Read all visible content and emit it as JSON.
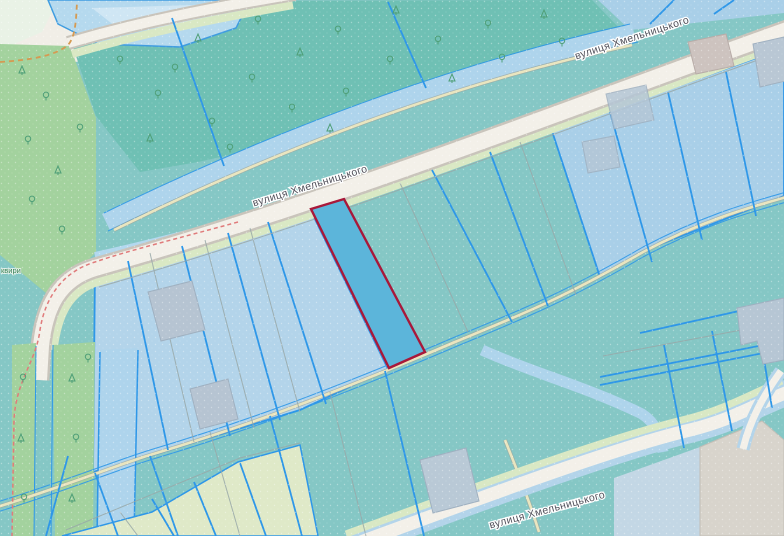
{
  "map": {
    "kind": "cadastral parcel map",
    "street_labels": {
      "upper": "вулиця Хмельницького",
      "middle": "вулиця Хмельницького",
      "bottom": "вулиця Хмельницького"
    },
    "partial_label_left_edge": "квири",
    "selected_parcel": {
      "outline_color": "#a8183a",
      "fill_color": "#5cb5da"
    },
    "colors": {
      "land_teal": "#85c7c5",
      "forest_teal": "#6fc0b4",
      "forest_green": "#a3d29e",
      "parcel_light_blue": "#a9cfe8",
      "parcel_border_blue": "#2e97e8",
      "road_fill": "#f3f0e9",
      "road_casing": "#c9c4bb",
      "road_verge_green": "#d9e8c4",
      "water_blue": "#b5d9ee",
      "canal_blue": "#aed4ec",
      "path_beige": "#e9e5bf",
      "building_gray_blue": "#b6c4d2",
      "track_orange_dashed": "#d59a52",
      "track_pink_dashed": "#e07b7b",
      "pale_green_parcel": "#dfe9c8",
      "junction_gray": "#d8d4cc",
      "label_text": "#50505a"
    }
  }
}
